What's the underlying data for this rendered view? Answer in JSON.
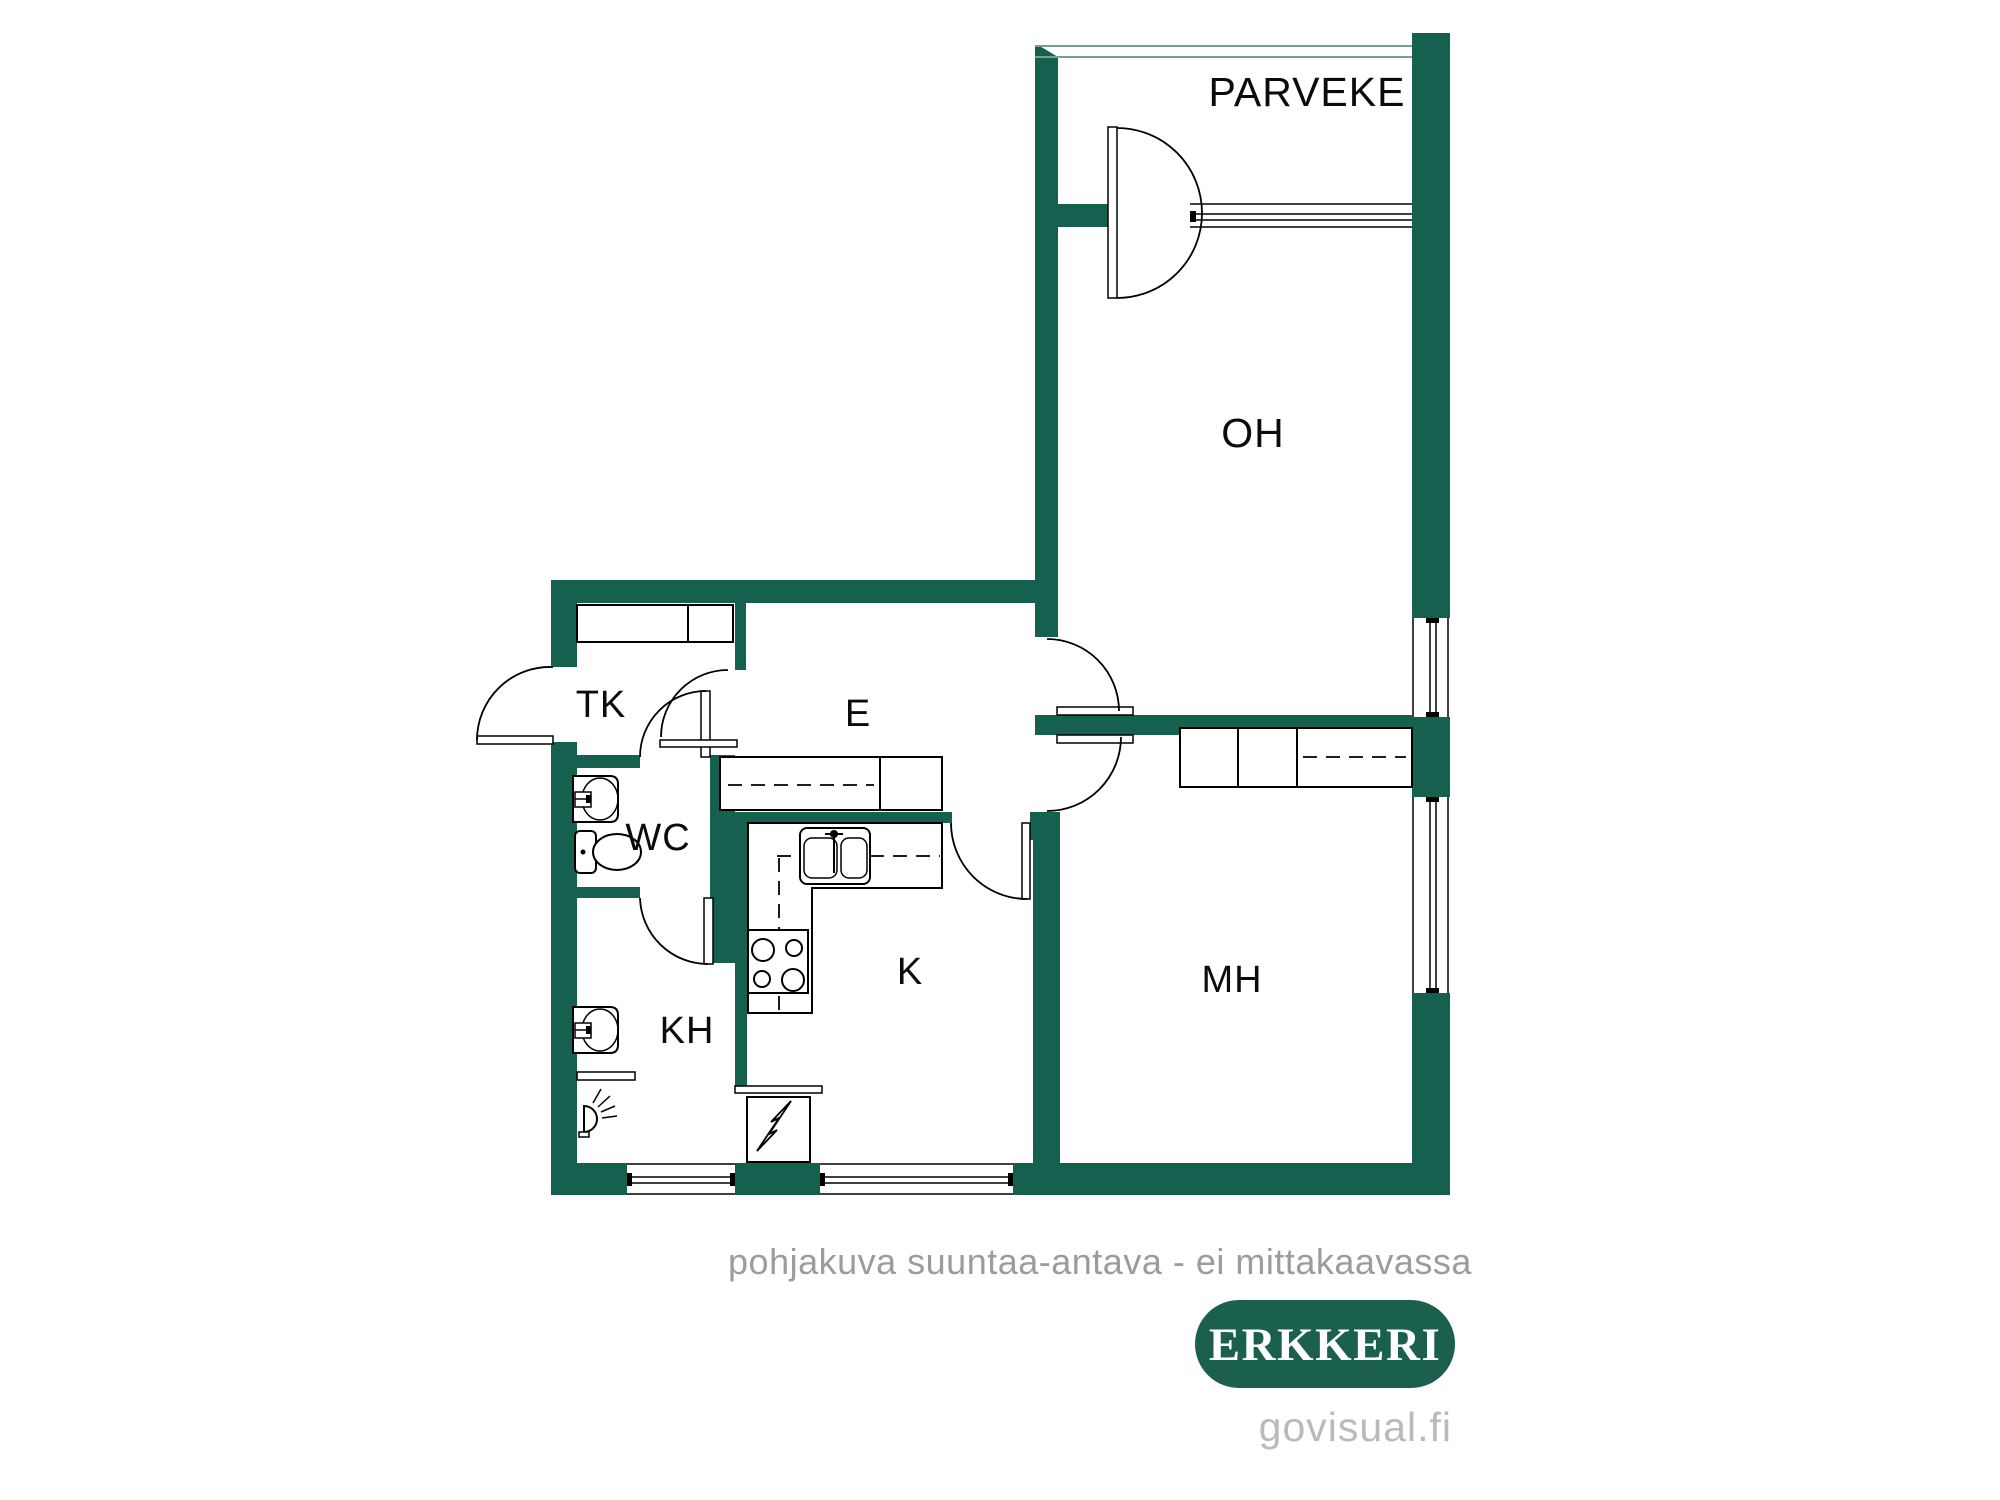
{
  "plan": {
    "rooms": {
      "balcony": "PARVEKE",
      "living_room": "OH",
      "hall": "E",
      "entry_closet": "TK",
      "wc": "WC",
      "kitchen": "K",
      "bathroom": "KH",
      "bedroom": "MH"
    },
    "note": "pohjakuva suuntaa-antava - ei mittakaavassa",
    "brand": {
      "badge": "ERKKERI",
      "website": "govisual.fi"
    },
    "colors": {
      "wall": "#15604E",
      "railing": "#74A193",
      "line": "#000000",
      "note-text": "#9C9C9C",
      "badge-bg": "#1B5F4E",
      "badge-text": "#FFFFFF",
      "url-text": "#B9BABB",
      "bg": "#FFFFFF"
    }
  }
}
